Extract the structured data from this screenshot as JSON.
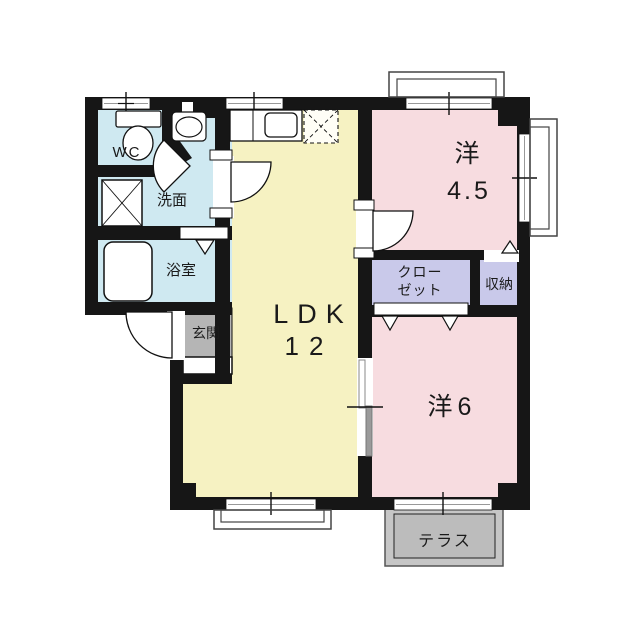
{
  "plan": {
    "wall_color": "#161616",
    "rooms": {
      "wc": {
        "label": "WC",
        "color": "#cfe9f1"
      },
      "senmen": {
        "label": "洗面",
        "color": "#cfe9f1"
      },
      "yokushitsu": {
        "label": "浴室",
        "color": "#cfe9f1"
      },
      "genkan": {
        "label": "玄関",
        "color": "#b5b5b5"
      },
      "ldk": {
        "label": "LDK",
        "size": "12",
        "color": "#f6f2c2"
      },
      "western45": {
        "label": "洋",
        "size": "4.5",
        "color": "#f7dce0"
      },
      "closet": {
        "line1": "クロー",
        "line2": "ゼット",
        "color": "#c9c9ea"
      },
      "storage": {
        "label": "収納",
        "color": "#c9c9ea"
      },
      "western6": {
        "label": "洋6",
        "color": "#f7dce0"
      },
      "terrace": {
        "label": "テラス",
        "color": "#c6c6c6"
      }
    }
  }
}
